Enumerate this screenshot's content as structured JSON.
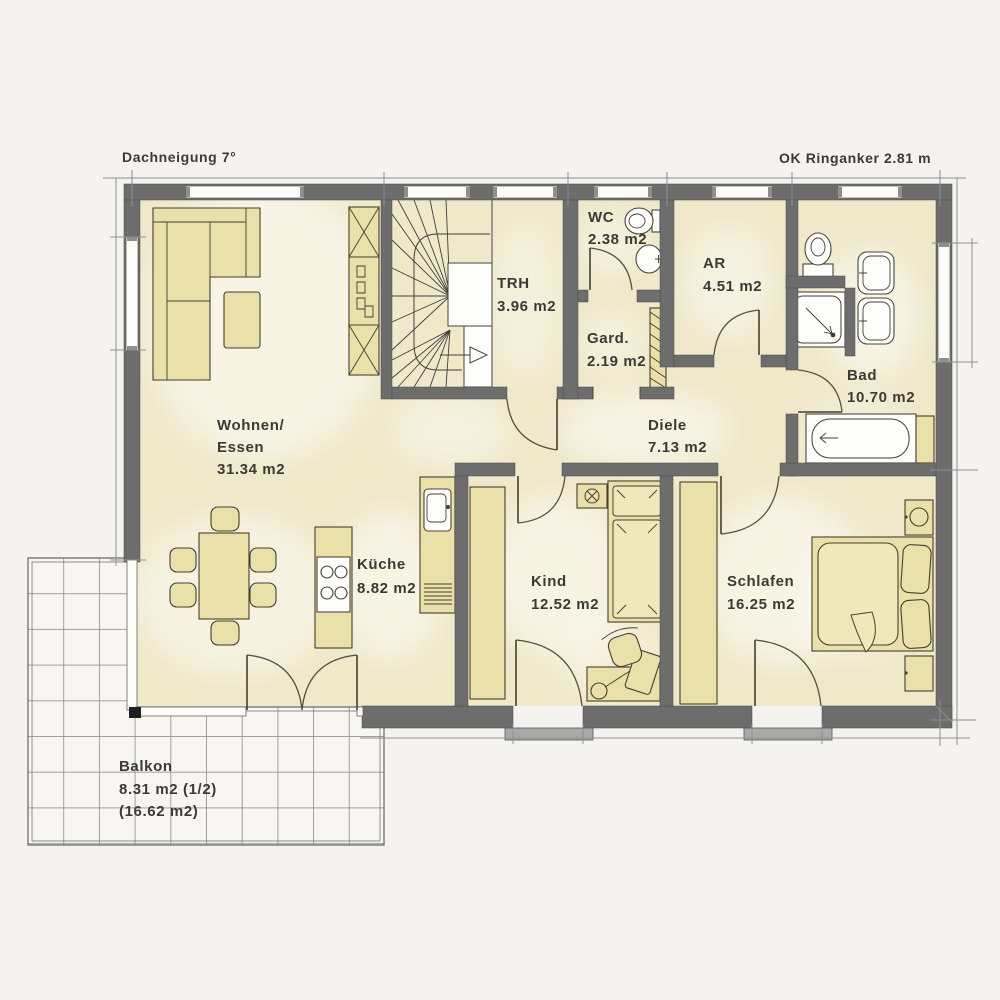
{
  "annotations": {
    "roof_pitch": "Dachneigung 7°",
    "ring_beam": "OK Ringanker 2.81 m"
  },
  "rooms": {
    "wohnen_essen": {
      "name_line1": "Wohnen/",
      "name_line2": "Essen",
      "area": "31.34 m2"
    },
    "kueche": {
      "name": "Küche",
      "area": "8.82 m2"
    },
    "trh": {
      "name": "TRH",
      "area": "3.96 m2"
    },
    "wc": {
      "name": "WC",
      "area": "2.38 m2"
    },
    "gard": {
      "name": "Gard.",
      "area": "2.19 m2"
    },
    "ar": {
      "name": "AR",
      "area": "4.51 m2"
    },
    "bad": {
      "name": "Bad",
      "area": "10.70 m2"
    },
    "diele": {
      "name": "Diele",
      "area": "7.13 m2"
    },
    "kind": {
      "name": "Kind",
      "area": "12.52 m2"
    },
    "schlafen": {
      "name": "Schlafen",
      "area": "16.25 m2"
    },
    "balkon": {
      "name": "Balkon",
      "area_half": "8.31 m2 (1/2)",
      "area_total": "(16.62 m2)"
    }
  },
  "colors": {
    "background": "#f4f3ef",
    "wall": "#6d6d6d",
    "floor": "#efe8c9",
    "furniture": "#eae0a9",
    "fixture": "#fdfdfc",
    "text": "#3b3a35",
    "balcony_tile_line": "#8c8c8c"
  }
}
